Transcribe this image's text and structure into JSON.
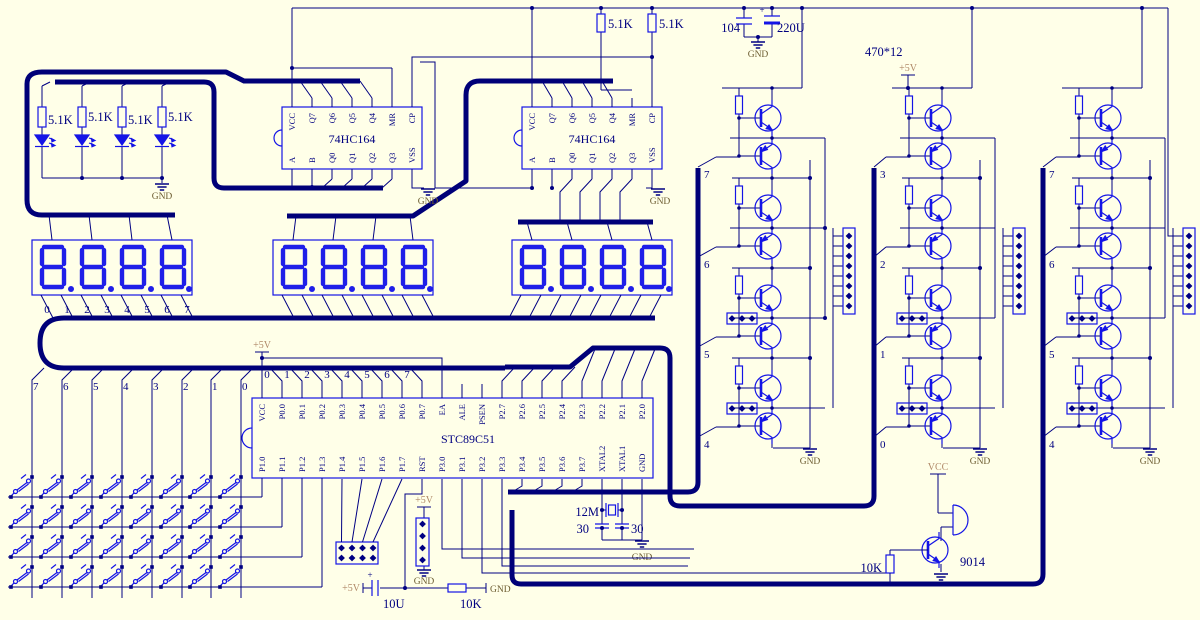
{
  "colors": {
    "background": "#FFFFE8",
    "wire": "#000082",
    "bus": "#000078",
    "component": "#1414e6",
    "segment": "#1f1fe8",
    "power_text": "#b08968",
    "gnd_text": "#6b5b2f"
  },
  "labels": {
    "gnd": "GND",
    "v5": "+5V",
    "vcc": "VCC",
    "plus": "+"
  },
  "top": {
    "r_pullup_a": "5.1K",
    "r_pullup_b": "5.1K",
    "c_bypass": "104",
    "c_bulk": "220U",
    "r_array": "470*12"
  },
  "led_block": {
    "resistors": [
      "5.1K",
      "5.1K",
      "5.1K",
      "5.1K"
    ]
  },
  "ics": {
    "shift1": {
      "title": "74HC164",
      "top_pins": [
        "VCC",
        "Q7",
        "Q6",
        "Q5",
        "Q4",
        "MR",
        "CP"
      ],
      "bottom_pins": [
        "A",
        "B",
        "Q0",
        "Q1",
        "Q2",
        "Q3",
        "VSS"
      ]
    },
    "shift2": {
      "title": "74HC164",
      "top_pins": [
        "VCC",
        "Q7",
        "Q6",
        "Q5",
        "Q4",
        "MR",
        "CP"
      ],
      "bottom_pins": [
        "A",
        "B",
        "Q0",
        "Q1",
        "Q2",
        "Q3",
        "VSS"
      ]
    },
    "mcu": {
      "title": "STC89C51",
      "top_pins": [
        "VCC",
        "P0.0",
        "P0.1",
        "P0.2",
        "P0.3",
        "P0.4",
        "P0.5",
        "P0.6",
        "P0.7",
        "EA",
        "ALE",
        "PSEN",
        "P2.7",
        "P2.6",
        "P2.5",
        "P2.4",
        "P2.3",
        "P2.2",
        "P2.1",
        "P2.0"
      ],
      "bottom_pins": [
        "P1.0",
        "P1.1",
        "P1.2",
        "P1.3",
        "P1.4",
        "P1.5",
        "P1.6",
        "P1.7",
        "RST",
        "P3.0",
        "P3.1",
        "P3.2",
        "P3.3",
        "P3.4",
        "P3.5",
        "P3.6",
        "P3.7",
        "XTAL2",
        "XTAL1",
        "GND"
      ]
    }
  },
  "displays": {
    "digit_pin_labels": [
      "0",
      "1",
      "2",
      "3",
      "4",
      "5",
      "6",
      "7"
    ]
  },
  "p0_bus_labels": [
    "0",
    "1",
    "2",
    "3",
    "4",
    "5",
    "6",
    "7"
  ],
  "key_bus_labels": [
    "7",
    "6",
    "5",
    "4",
    "3",
    "2",
    "1",
    "0"
  ],
  "drivers": {
    "col1_taps": [
      "7",
      "6",
      "5",
      "4"
    ],
    "col2_taps": [
      "3",
      "2",
      "1",
      "0"
    ],
    "col3_taps": [
      "7",
      "6",
      "5",
      "4"
    ]
  },
  "bottom": {
    "c_reset": "10U",
    "r_reset": "10K",
    "xtal": "12M",
    "c_load_a": "30",
    "c_load_b": "30",
    "r_base": "10K",
    "transistor": "9014"
  }
}
